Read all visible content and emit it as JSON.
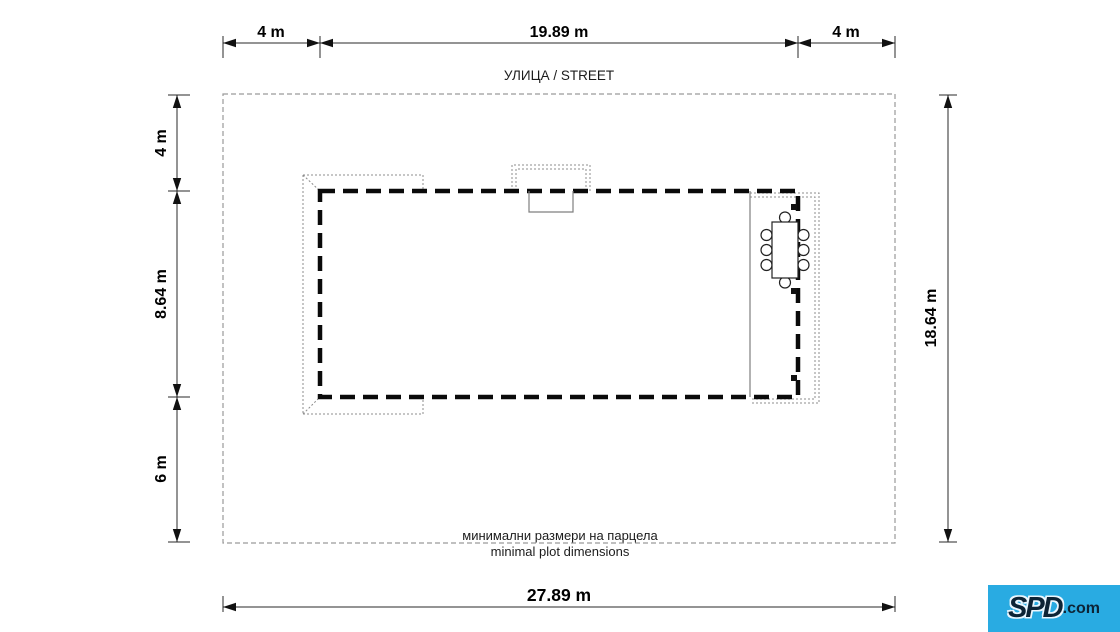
{
  "drawing": {
    "street_label": "УЛИЦА / STREET",
    "caption": {
      "line1": "минимални размери на парцела",
      "line2": "minimal plot dimensions"
    },
    "dimensions": {
      "top_left_setback": "4 m",
      "building_width": "19.89 m",
      "top_right_setback": "4 m",
      "left_top_setback": "4 m",
      "building_depth": "8.64 m",
      "left_bottom_setback": "6 m",
      "plot_depth": "18.64 m",
      "plot_width": "27.89 m"
    },
    "colors": {
      "line": "#000000",
      "plot_boundary": "#9a9a9a",
      "roof_dotted": "#8c8c8c"
    }
  },
  "logo": {
    "brand": "SPD",
    "suffix": ".com",
    "background": "#29abe2",
    "text_color": "#0d2436"
  }
}
